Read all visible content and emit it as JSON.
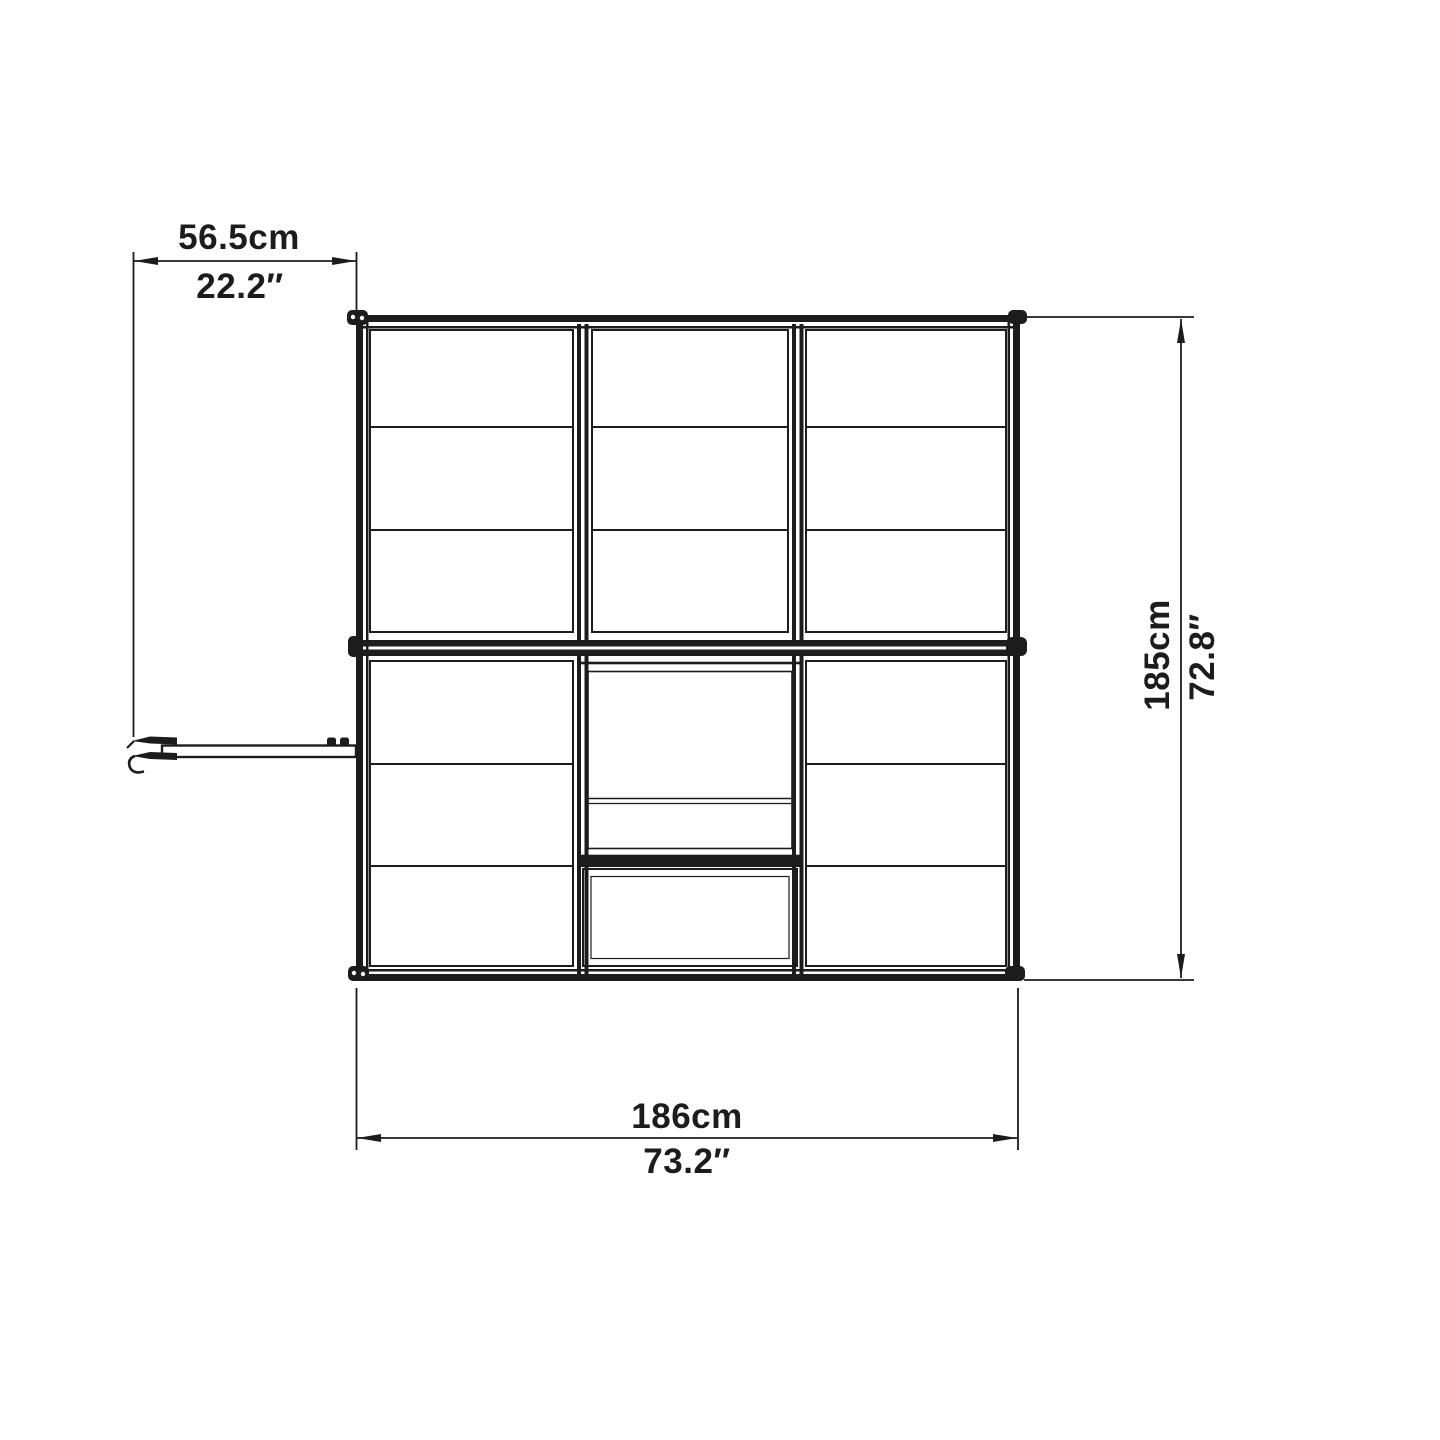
{
  "diagram": {
    "title": "greenhouse-top-view-dimension-drawing",
    "background": "#ffffff",
    "line_color": "#1c1c1c",
    "labels": {
      "door_projection": {
        "metric": "56.5cm",
        "imperial": "22.2″"
      },
      "depth": {
        "metric": "185cm",
        "imperial": "72.8″"
      },
      "width": {
        "metric": "186cm",
        "imperial": "73.2″"
      }
    }
  }
}
